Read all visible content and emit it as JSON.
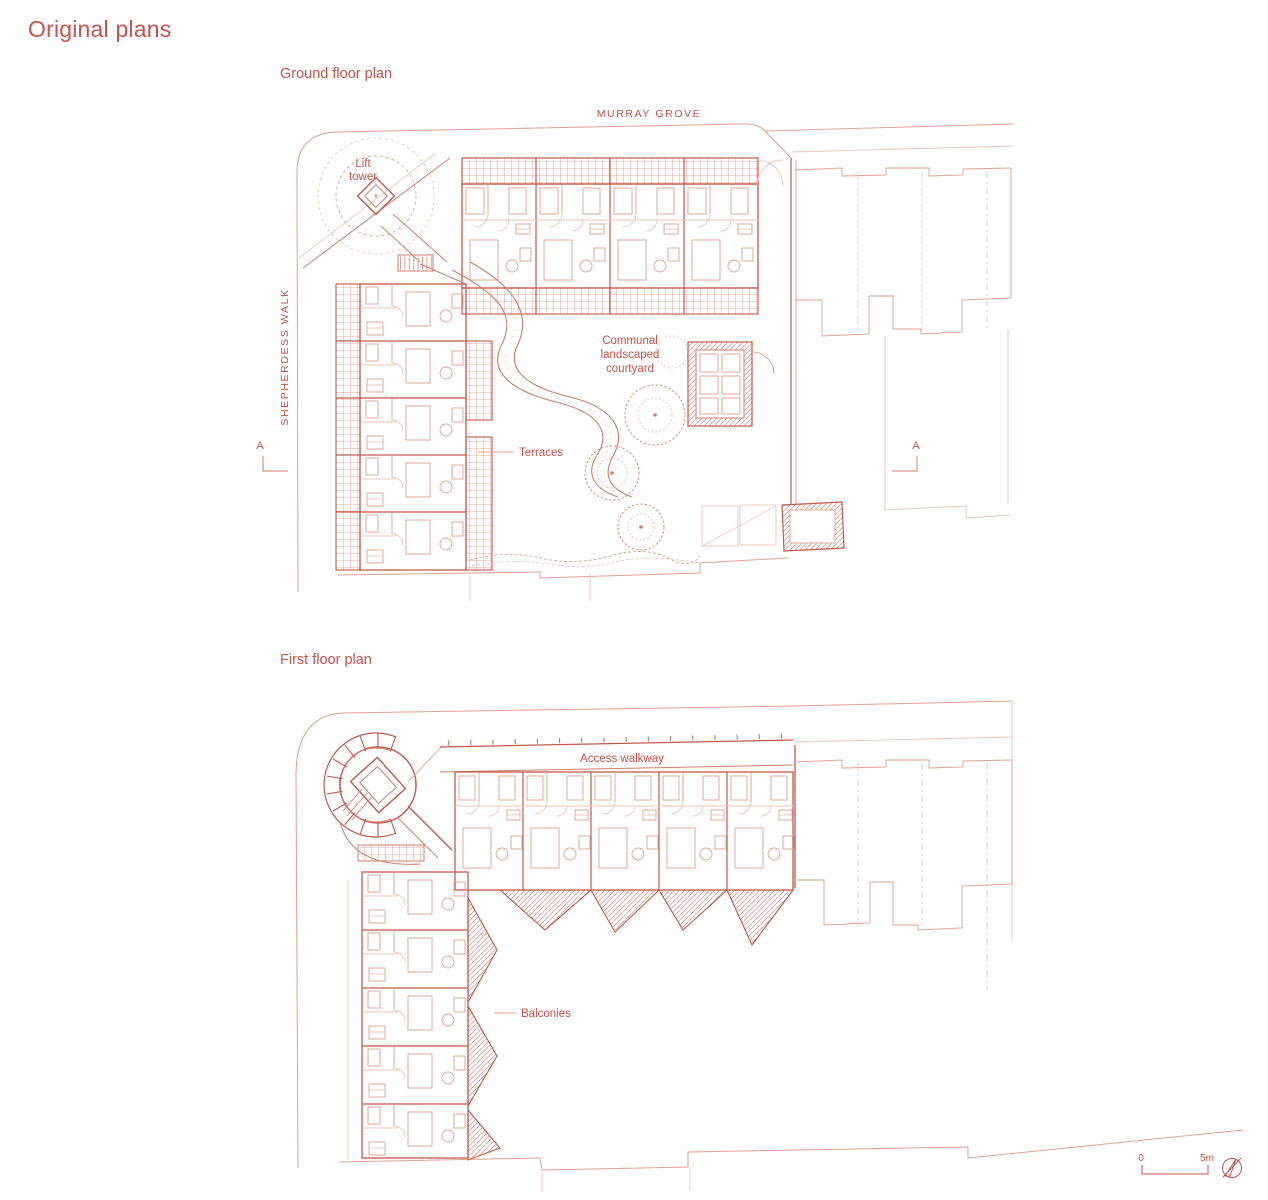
{
  "page": {
    "title": "Original plans"
  },
  "colors": {
    "accent": "#c5544c",
    "line_strong": "#c25a4c",
    "line_medium": "#d07f6f",
    "line_light": "#dfa193",
    "line_faint": "#ecc4bb",
    "hatch": "#dc9184"
  },
  "ground_plan": {
    "label": "Ground floor plan",
    "street_top": "MURRAY GROVE",
    "street_left": "SHEPHERDESS WALK",
    "lift_tower": {
      "line1": "Lift",
      "line2": "tower"
    },
    "courtyard": {
      "line1": "Communal",
      "line2": "landscaped",
      "line3": "courtyard"
    },
    "terraces": "Terraces",
    "section_left": "A",
    "section_right": "A"
  },
  "first_plan": {
    "label": "First floor plan",
    "access_walkway": "Access walkway",
    "balconies": "Balconies"
  },
  "scale_bar": {
    "zero": "0",
    "five_m": "5m",
    "north_icon": "north-arrow-icon"
  }
}
